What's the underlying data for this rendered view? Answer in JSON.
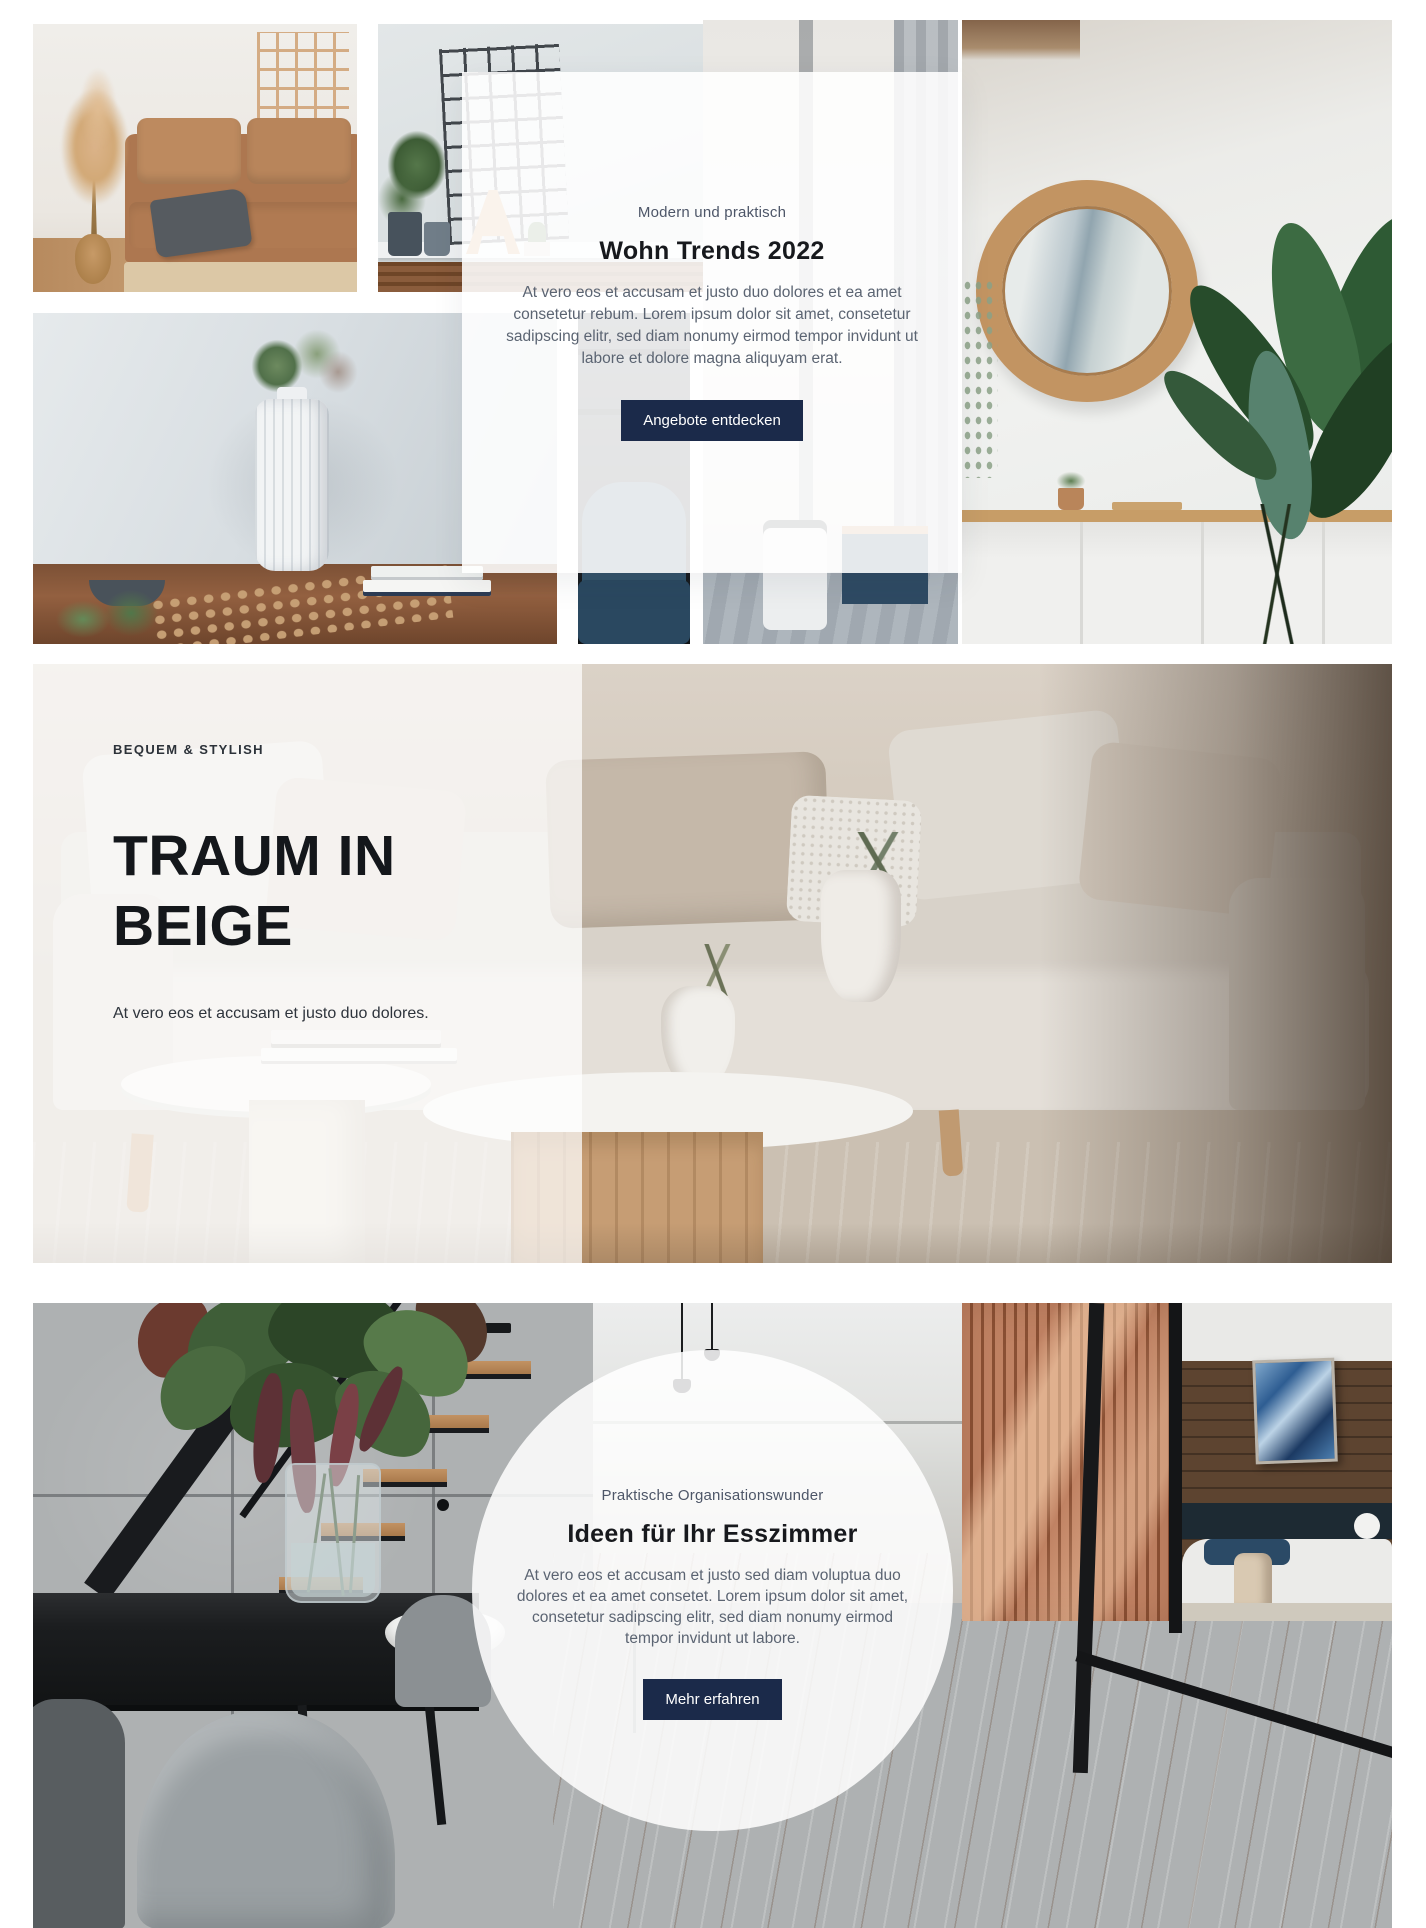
{
  "accent_color": "#1b2a4a",
  "top_section": {
    "card": {
      "eyebrow": "Modern und praktisch",
      "title": "Wohn Trends 2022",
      "body": "At vero eos et accusam et justo duo dolores et ea amet consetetur rebum. Lorem ipsum dolor sit amet, consetetur sadipscing elitr, sed diam nonumy eirmod tempor invidunt ut labore et dolore magna aliquyam erat.",
      "button_label": "Angebote entdecken"
    }
  },
  "beige_section": {
    "eyebrow": "BEQUEM & STYLISH",
    "title": "TRAUM IN BEIGE",
    "subtext": "At vero eos et accusam et justo duo dolores."
  },
  "dining_section": {
    "circle": {
      "eyebrow": "Praktische Organisationswunder",
      "title": "Ideen für Ihr Esszimmer",
      "body": "At vero eos et accusam et justo sed diam voluptua duo dolores et ea amet consetet. Lorem ipsum dolor sit amet, consetetur sadipscing elitr, sed diam nonumy eirmod tempor invidunt ut labore.",
      "button_label": "Mehr erfahren"
    }
  }
}
